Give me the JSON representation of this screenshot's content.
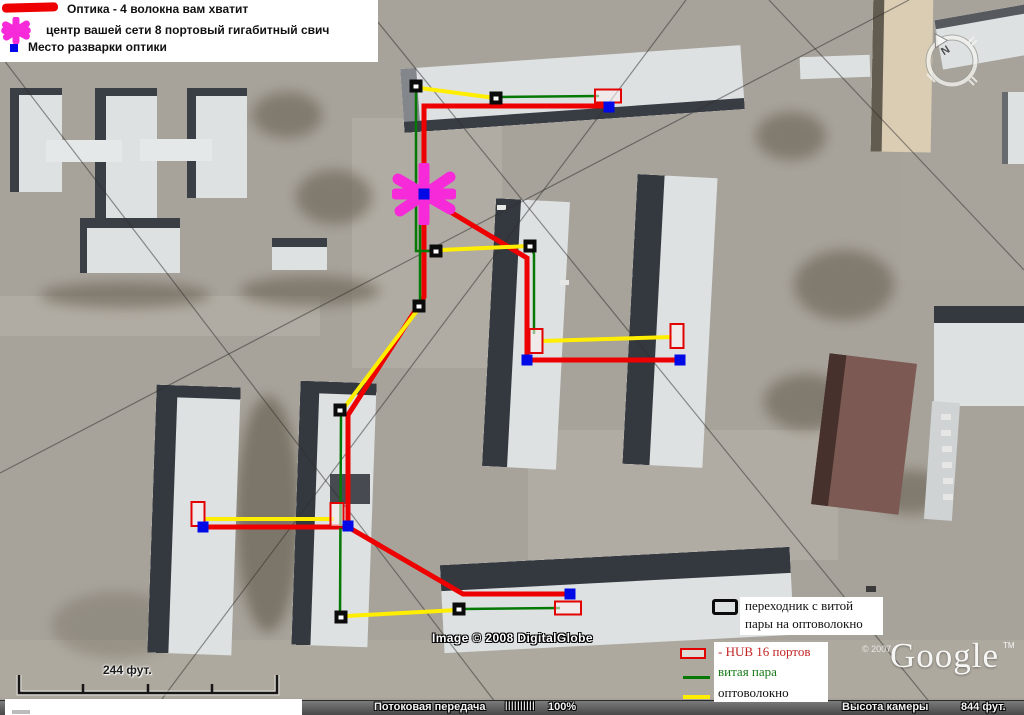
{
  "legend_top": {
    "items": [
      {
        "icon": "red-optic-line-icon",
        "label": "Оптика - 4 волокна вам хватит"
      },
      {
        "icon": "magenta-star-icon",
        "label": "центр вашей сети 8 портовый гигабитный свич"
      },
      {
        "icon": "blue-square-icon",
        "label": "Место разварки оптики"
      }
    ]
  },
  "legend_bottom": {
    "adapter_line1": "переходник с витой",
    "adapter_line2": "пары на оптоволокно",
    "hub": "- HUB 16 портов",
    "twisted_pair": "витая пара",
    "fiber": "оптоволокно"
  },
  "watermarks": {
    "image_credit": "Image © 2008 DigitalGlobe",
    "google_year": "© 2007",
    "google": "Google",
    "google_tm": "TM",
    "compass_north": "N"
  },
  "scalebar": {
    "label": "244 фут."
  },
  "statusbar": {
    "streaming_label": "Потоковая передача",
    "streaming_bars": "||||||||||",
    "streaming_percent": "100%",
    "camera_label": "Высота камеры",
    "camera_altitude": "844 фут."
  },
  "network": {
    "styles": {
      "optic": {
        "color": "#ee0000",
        "width": 5
      },
      "twisted": {
        "color": "#067806",
        "width": 2.5
      },
      "fiber": {
        "color": "#ffee00",
        "width": 4
      }
    },
    "segments": [
      {
        "kind": "optic",
        "pts": [
          [
            424,
            196
          ],
          [
            424,
            106
          ],
          [
            609,
            106
          ]
        ]
      },
      {
        "kind": "optic",
        "pts": [
          [
            424,
            196
          ],
          [
            527,
            258
          ],
          [
            527,
            360
          ],
          [
            679,
            360
          ]
        ]
      },
      {
        "kind": "optic",
        "pts": [
          [
            424,
            196
          ],
          [
            424,
            297
          ],
          [
            348,
            415
          ],
          [
            348,
            527
          ],
          [
            204,
            527
          ]
        ]
      },
      {
        "kind": "optic",
        "pts": [
          [
            348,
            527
          ],
          [
            463,
            594
          ],
          [
            569,
            594
          ]
        ]
      },
      {
        "kind": "twisted",
        "pts": [
          [
            416,
            88
          ],
          [
            416,
            251
          ],
          [
            434,
            251
          ]
        ]
      },
      {
        "kind": "twisted",
        "pts": [
          [
            420,
            198
          ],
          [
            420,
            305
          ]
        ]
      },
      {
        "kind": "twisted",
        "pts": [
          [
            531,
            248
          ],
          [
            534,
            254
          ],
          [
            534,
            334
          ]
        ]
      },
      {
        "kind": "twisted",
        "pts": [
          [
            341,
            413
          ],
          [
            340,
            616
          ]
        ]
      },
      {
        "kind": "twisted",
        "pts": [
          [
            499,
            97
          ],
          [
            599,
            96
          ]
        ]
      },
      {
        "kind": "twisted",
        "pts": [
          [
            461,
            609
          ],
          [
            560,
            608
          ]
        ]
      },
      {
        "kind": "fiber",
        "pts": [
          [
            420,
            88
          ],
          [
            495,
            98
          ]
        ]
      },
      {
        "kind": "fiber",
        "pts": [
          [
            441,
            250
          ],
          [
            529,
            246
          ]
        ]
      },
      {
        "kind": "fiber",
        "pts": [
          [
            542,
            341
          ],
          [
            672,
            337
          ]
        ]
      },
      {
        "kind": "fiber",
        "pts": [
          [
            419,
            308
          ],
          [
            344,
            408
          ]
        ]
      },
      {
        "kind": "fiber",
        "pts": [
          [
            205,
            519
          ],
          [
            334,
            519
          ]
        ]
      },
      {
        "kind": "fiber",
        "pts": [
          [
            346,
            616
          ],
          [
            458,
            610
          ]
        ]
      }
    ],
    "nodes": [
      {
        "type": "star",
        "x": 424,
        "y": 194
      },
      {
        "type": "adapter",
        "x": 416,
        "y": 86
      },
      {
        "type": "adapter",
        "x": 496,
        "y": 98
      },
      {
        "type": "adapter",
        "x": 436,
        "y": 251
      },
      {
        "type": "adapter",
        "x": 530,
        "y": 246
      },
      {
        "type": "adapter",
        "x": 419,
        "y": 306
      },
      {
        "type": "adapter",
        "x": 340,
        "y": 410
      },
      {
        "type": "adapter",
        "x": 341,
        "y": 617
      },
      {
        "type": "adapter",
        "x": 459,
        "y": 609
      },
      {
        "type": "hub_v",
        "x": 198,
        "y": 514
      },
      {
        "type": "hub_v",
        "x": 337,
        "y": 515
      },
      {
        "type": "hub_v",
        "x": 536,
        "y": 341
      },
      {
        "type": "hub_v",
        "x": 677,
        "y": 336
      },
      {
        "type": "hub_h",
        "x": 608,
        "y": 96
      },
      {
        "type": "hub_h",
        "x": 568,
        "y": 608
      },
      {
        "type": "splice",
        "x": 424,
        "y": 194
      },
      {
        "type": "splice",
        "x": 609,
        "y": 107
      },
      {
        "type": "splice",
        "x": 527,
        "y": 360
      },
      {
        "type": "splice",
        "x": 680,
        "y": 360
      },
      {
        "type": "splice",
        "x": 348,
        "y": 526
      },
      {
        "type": "splice",
        "x": 203,
        "y": 527
      },
      {
        "type": "splice",
        "x": 570,
        "y": 594
      }
    ]
  }
}
